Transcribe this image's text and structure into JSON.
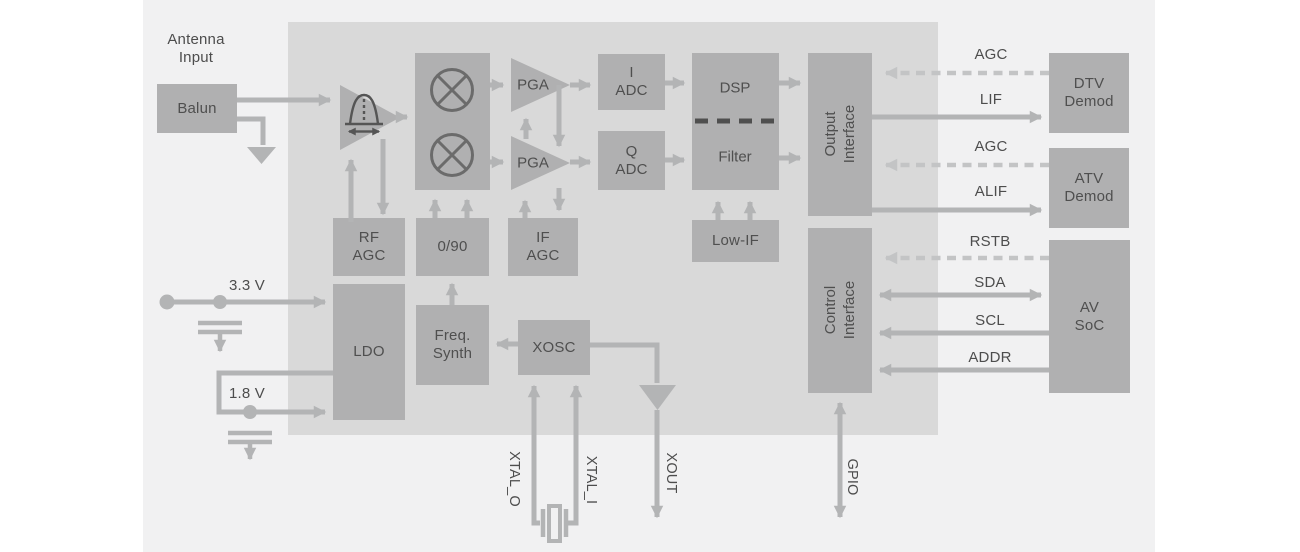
{
  "colors": {
    "canvas": "#f1f1f2",
    "chip": "#d9d9d9",
    "block": "#b0b0b1",
    "wire": "#b3b4b5",
    "wire_dashed": "#c3c4c5",
    "icon_dark": "#555555",
    "mixer_stroke": "#6b6b6b",
    "text": "#4d4d4d"
  },
  "blocks": {
    "balun": "Balun",
    "pga_i": "PGA",
    "pga_q": "PGA",
    "adc_i": [
      "I",
      "ADC"
    ],
    "adc_q": [
      "Q",
      "ADC"
    ],
    "dsp": "DSP",
    "filter": "Filter",
    "output_interface": [
      "Output",
      "Interface"
    ],
    "low_if": "Low-IF",
    "rf_agc": [
      "RF",
      "AGC"
    ],
    "quad": "0/90",
    "if_agc": [
      "IF",
      "AGC"
    ],
    "ldo": "LDO",
    "freq_synth": [
      "Freq.",
      "Synth"
    ],
    "xosc": "XOSC",
    "control_interface": [
      "Control",
      "Interface"
    ],
    "dtv_demod": [
      "DTV",
      "Demod"
    ],
    "atv_demod": [
      "ATV",
      "Demod"
    ],
    "av_soc": [
      "AV",
      "SoC"
    ]
  },
  "labels": {
    "antenna_input": [
      "Antenna",
      "Input"
    ],
    "supply_3v3": "3.3 V",
    "supply_1v8": "1.8 V"
  },
  "signals": {
    "agc_dtv": "AGC",
    "lif": "LIF",
    "agc_atv": "AGC",
    "alif": "ALIF",
    "rstb": "RSTB",
    "sda": "SDA",
    "scl": "SCL",
    "addr": "ADDR",
    "xtal_o": "XTAL_O",
    "xtal_i": "XTAL_I",
    "xout": "XOUT",
    "gpio": "GPIO"
  }
}
